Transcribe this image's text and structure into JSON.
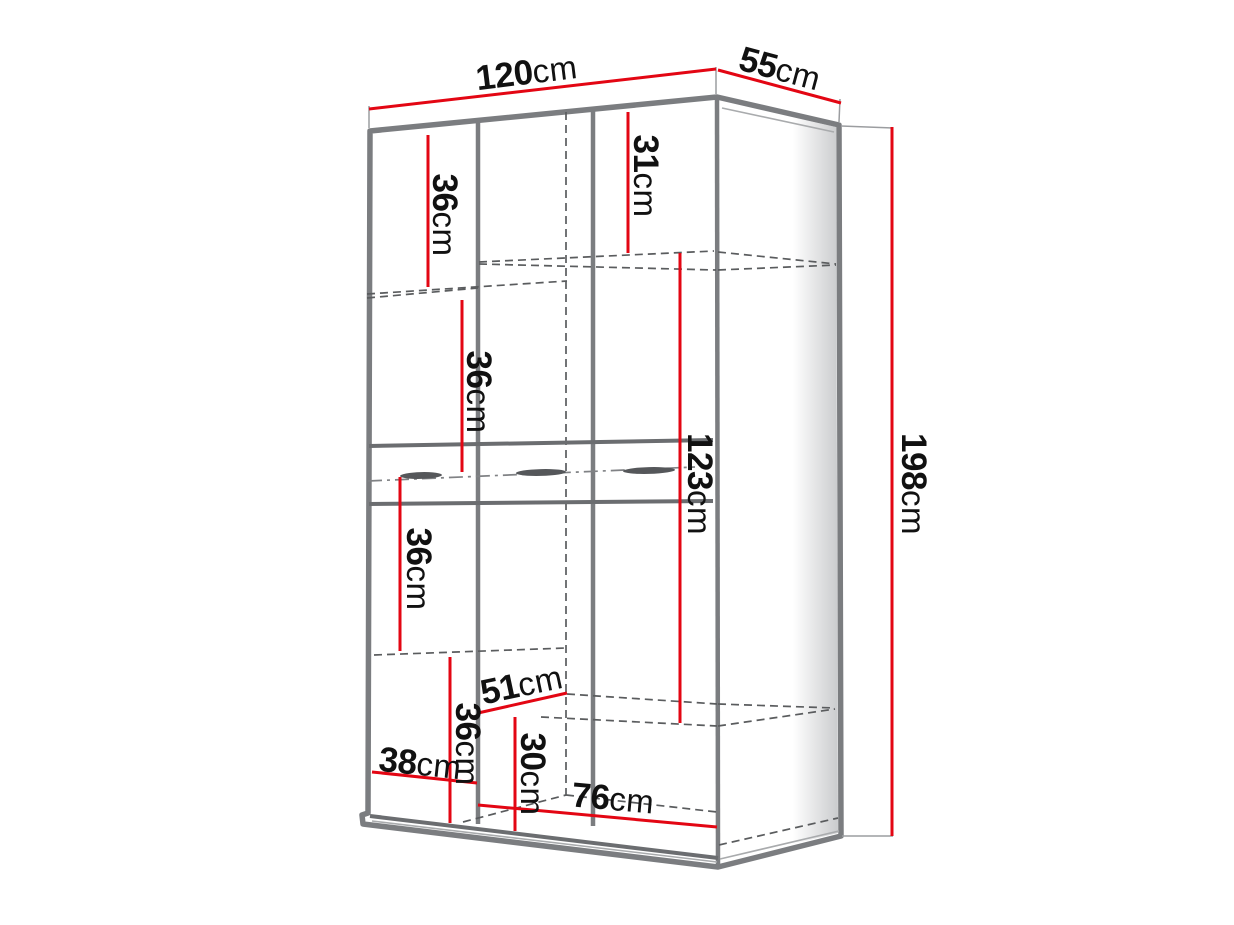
{
  "page": {
    "background": "#ffffff",
    "subject": "wardrobe-dimension-diagram"
  },
  "unit": "cm",
  "colors": {
    "dimension_line": "#e30613",
    "outline": "#7b7d80",
    "dark_line": "#6b6d70",
    "dashed_line": "#5a5c5e",
    "label_text": "#111111"
  },
  "labels": {
    "w120": {
      "num": "120",
      "unit": "cm"
    },
    "d55": {
      "num": "55",
      "unit": "cm"
    },
    "h198": {
      "num": "198",
      "unit": "cm"
    },
    "s36a": {
      "num": "36",
      "unit": "cm"
    },
    "s31": {
      "num": "31",
      "unit": "cm"
    },
    "s36b": {
      "num": "36",
      "unit": "cm"
    },
    "h123": {
      "num": "123",
      "unit": "cm"
    },
    "s36c": {
      "num": "36",
      "unit": "cm"
    },
    "s36d": {
      "num": "36",
      "unit": "cm"
    },
    "d51": {
      "num": "51",
      "unit": "cm"
    },
    "h30": {
      "num": "30",
      "unit": "cm"
    },
    "w38": {
      "num": "38",
      "unit": "cm"
    },
    "w76": {
      "num": "76",
      "unit": "cm"
    }
  },
  "measurements": [
    {
      "name": "overall-width",
      "value": 120,
      "unit": "cm"
    },
    {
      "name": "overall-depth",
      "value": 55,
      "unit": "cm"
    },
    {
      "name": "overall-height",
      "value": 198,
      "unit": "cm"
    },
    {
      "name": "top-left-shelf-gap",
      "value": 36,
      "unit": "cm"
    },
    {
      "name": "top-right-shelf-gap",
      "value": 31,
      "unit": "cm"
    },
    {
      "name": "second-left-shelf-gap",
      "value": 36,
      "unit": "cm"
    },
    {
      "name": "hanging-section-height",
      "value": 123,
      "unit": "cm"
    },
    {
      "name": "third-left-shelf-gap",
      "value": 36,
      "unit": "cm"
    },
    {
      "name": "fourth-left-shelf-gap",
      "value": 36,
      "unit": "cm"
    },
    {
      "name": "shelf-depth",
      "value": 51,
      "unit": "cm"
    },
    {
      "name": "bottom-compartment-height",
      "value": 30,
      "unit": "cm"
    },
    {
      "name": "left-section-width",
      "value": 38,
      "unit": "cm"
    },
    {
      "name": "right-section-width",
      "value": 76,
      "unit": "cm"
    }
  ]
}
